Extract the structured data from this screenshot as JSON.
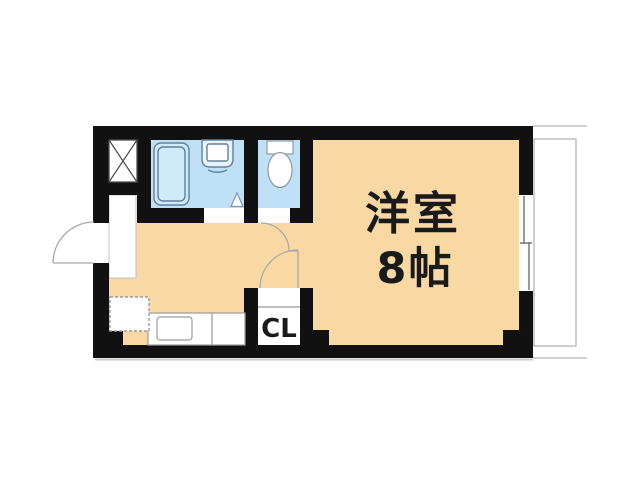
{
  "labels": {
    "main_room_name": "洋室",
    "main_room_size": "8帖",
    "closet": "CL"
  },
  "colors": {
    "wall": "#111111",
    "floor": "#f8d8a3",
    "wet_area": "#c0e1f5",
    "bathtub_fill": "#cfeaf8",
    "fixture_stroke": "#63809c",
    "gray_stroke": "#9b9b9b",
    "door_arc": "#a9a9a9",
    "balcony_line": "#b4b4b4",
    "shadow": "#cccccc",
    "label_text": "#1a1a1a",
    "background": "#ffffff"
  }
}
